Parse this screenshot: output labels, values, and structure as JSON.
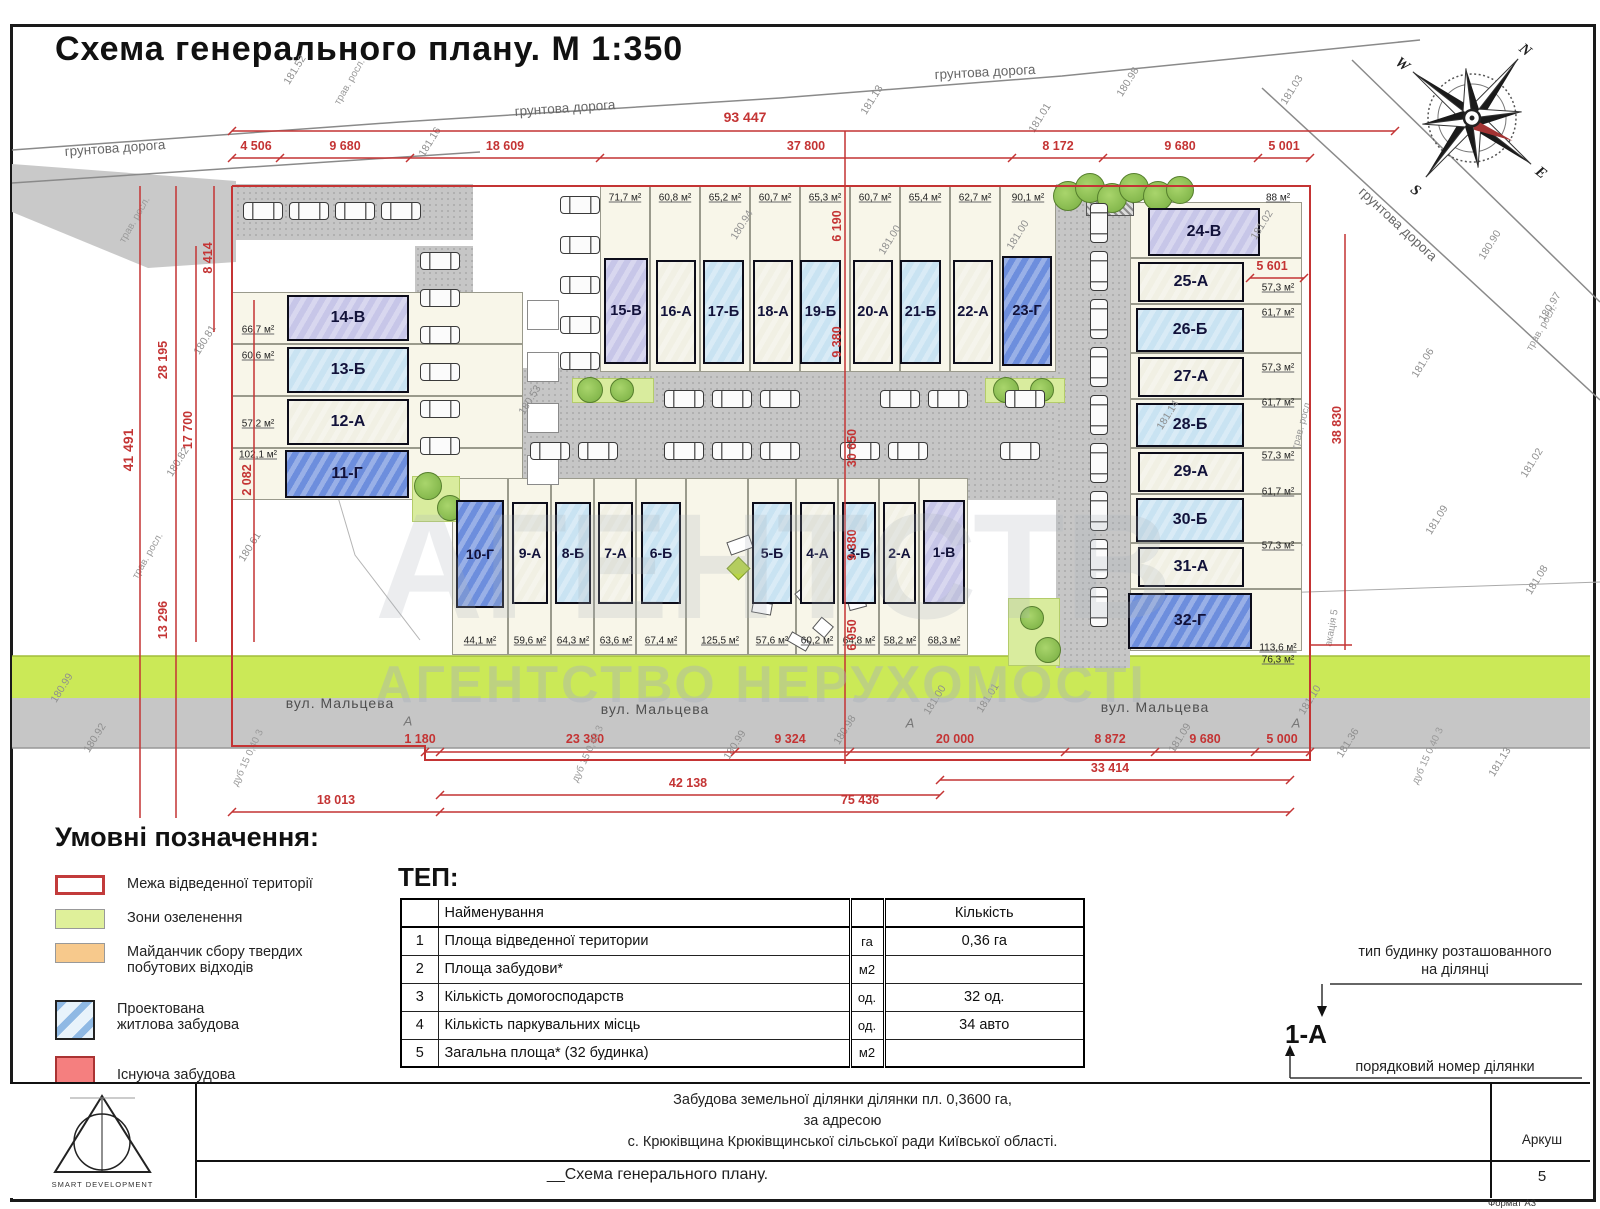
{
  "title": "Схема генерального плану. М 1:350",
  "compass": {
    "n": "N",
    "e": "E",
    "s": "S",
    "w": "W"
  },
  "plan": {
    "road_labels": [
      "грунтова дорога",
      "грунтова дорога",
      "грунтова дорога",
      "грунтова дорога"
    ],
    "street_labels": [
      "вул. Мальцева",
      "вул. Мальцева",
      "вул. Мальцева"
    ],
    "road_markers": [
      "А",
      "А",
      "А"
    ],
    "veg_labels": [
      "трав. росл.",
      "трав. росл.",
      "трав. росл.",
      "трав. росл.",
      "трав. росл."
    ],
    "tree_labels": [
      "акація 5",
      "дуб 15 0,40 3",
      "дуб 15 0,40 3",
      "дуб 15 0,40 3"
    ],
    "elevations": [
      "181.52",
      "181.16",
      "180.94",
      "181.13",
      "181.01",
      "180.98",
      "181.03",
      "181.00",
      "181.00",
      "181.14",
      "180.53",
      "180.81",
      "180.82",
      "180.61",
      "180.99",
      "180.92",
      "180.99",
      "180.98",
      "181.00",
      "181.01",
      "181.09",
      "181.10",
      "181.36",
      "181.13",
      "181.06",
      "181.09",
      "181.02",
      "181.08",
      "180.97",
      "180.90",
      "181.02"
    ],
    "watermark_big": "АГЕНТСТВО НЕРУХОМОСТІ",
    "watermark_small": "АГЕНТСТВО НЕРУХОМОСТІ"
  },
  "dimensions": {
    "top_total": "93 447",
    "top_segments": [
      "4 506",
      "9 680",
      "18 609",
      "37 800",
      "8 172",
      "9 680",
      "5 001"
    ],
    "left": [
      "41 491",
      "28 195",
      "17 700",
      "13 296",
      "8 414",
      "2 082"
    ],
    "right": [
      "5 601",
      "38 830"
    ],
    "inner": [
      "6 190",
      "9 380",
      "30 650",
      "9 380",
      "6 050"
    ],
    "bottom_row1": [
      "1 180",
      "23 380",
      "9 324",
      "20 000",
      "8 872",
      "9 680",
      "5 000"
    ],
    "bottom_row2": [
      "33 414",
      "42 138"
    ],
    "bottom_row3": [
      "18 013",
      "75 436"
    ]
  },
  "buildings": [
    {
      "id": "1-В",
      "type": "В",
      "area": "68,3 м²"
    },
    {
      "id": "2-А",
      "type": "А",
      "area": "58,2 м²"
    },
    {
      "id": "3-Б",
      "type": "Б",
      "area": "64,8 м²"
    },
    {
      "id": "4-А",
      "type": "А",
      "area": "60,2 м²"
    },
    {
      "id": "5-Б",
      "type": "Б",
      "area": "57,6 м²"
    },
    {
      "id": "6-Б",
      "type": "Б",
      "area": "67,4 м²"
    },
    {
      "id": "7-А",
      "type": "А",
      "area": "63,6 м²"
    },
    {
      "id": "8-Б",
      "type": "Б",
      "area": "64,3 м²"
    },
    {
      "id": "9-А",
      "type": "А",
      "area": "59,6 м²"
    },
    {
      "id": "10-Г",
      "type": "Г",
      "area": "44,1 м²"
    },
    {
      "id": "11-Г",
      "type": "Г",
      "area": "102,1 м²"
    },
    {
      "id": "12-А",
      "type": "А",
      "area": "57,2 м²"
    },
    {
      "id": "13-Б",
      "type": "Б",
      "area": "60,6 м²"
    },
    {
      "id": "14-В",
      "type": "В",
      "area": "66,7 м²"
    },
    {
      "id": "15-В",
      "type": "В",
      "area": "71,7 м²"
    },
    {
      "id": "16-А",
      "type": "А",
      "area": "60,8 м²"
    },
    {
      "id": "17-Б",
      "type": "Б",
      "area": "65,2 м²"
    },
    {
      "id": "18-А",
      "type": "А",
      "area": "60,7 м²"
    },
    {
      "id": "19-Б",
      "type": "Б",
      "area": "65,3 м²"
    },
    {
      "id": "20-А",
      "type": "А",
      "area": "60,7 м²"
    },
    {
      "id": "21-Б",
      "type": "Б",
      "area": "65,4 м²"
    },
    {
      "id": "22-А",
      "type": "А",
      "area": "62,7 м²"
    },
    {
      "id": "23-Г",
      "type": "Г",
      "area": "90,1 м²"
    },
    {
      "id": "24-В",
      "type": "В",
      "area": "88 м²"
    },
    {
      "id": "25-А",
      "type": "А",
      "area": "57,3 м²"
    },
    {
      "id": "26-Б",
      "type": "Б",
      "area": "61,7 м²"
    },
    {
      "id": "27-А",
      "type": "А",
      "area": "57,3 м²"
    },
    {
      "id": "28-Б",
      "type": "Б",
      "area": "61,7 м²"
    },
    {
      "id": "29-А",
      "type": "А",
      "area": "57,3 м²"
    },
    {
      "id": "30-Б",
      "type": "Б",
      "area": "61,7 м²"
    },
    {
      "id": "31-А",
      "type": "А",
      "area": "57,3 м²"
    },
    {
      "id": "32-Г",
      "type": "Г",
      "area": "113,6 м²"
    }
  ],
  "extra_areas": [
    "125,5 м²",
    "76,3 м²"
  ],
  "legend": {
    "heading": "Умовні позначення:",
    "items": [
      {
        "label": "Межа відведенної території"
      },
      {
        "label": "Зони озеленення"
      },
      {
        "label": "Майданчик сбору твердих\nпобутових відходів"
      },
      {
        "label": "Проектована\nжитлова забудова"
      },
      {
        "label": "Існуюча забудова"
      }
    ]
  },
  "tep": {
    "heading": "ТЕП:",
    "col_name": "Найменування",
    "col_qty": "Кількість",
    "rows": [
      {
        "num": "1",
        "name": "Площа відведенної територии",
        "unit": "га",
        "qty": "0,36 га"
      },
      {
        "num": "2",
        "name": "Площа забудови*",
        "unit": "м2",
        "qty": ""
      },
      {
        "num": "3",
        "name": "Кількість домогосподарств",
        "unit": "од.",
        "qty": "32 од."
      },
      {
        "num": "4",
        "name": "Кількість паркувальних місць",
        "unit": "од.",
        "qty": "34 авто"
      },
      {
        "num": "5",
        "name": "Загальна площа* (32 будинка)",
        "unit": "м2",
        "qty": ""
      }
    ]
  },
  "type_note": {
    "top1": "тип будинку розташованного",
    "top2": "на ділянці",
    "code": "1-А",
    "bottom": "порядковий номер ділянки"
  },
  "footer": {
    "line1": "Забудова земельної ділянки  ділянки пл. 0,3600 га,",
    "line2": "за адресою",
    "line3": "с. Крюківщина Крюківщинської сільської ради Київської області.",
    "doc_title": "__Схема генерального плану.",
    "sheet_label": "Аркуш",
    "sheet_number": "5",
    "format": "Формат А3",
    "logo": "SMART DEVELOPMENT"
  }
}
